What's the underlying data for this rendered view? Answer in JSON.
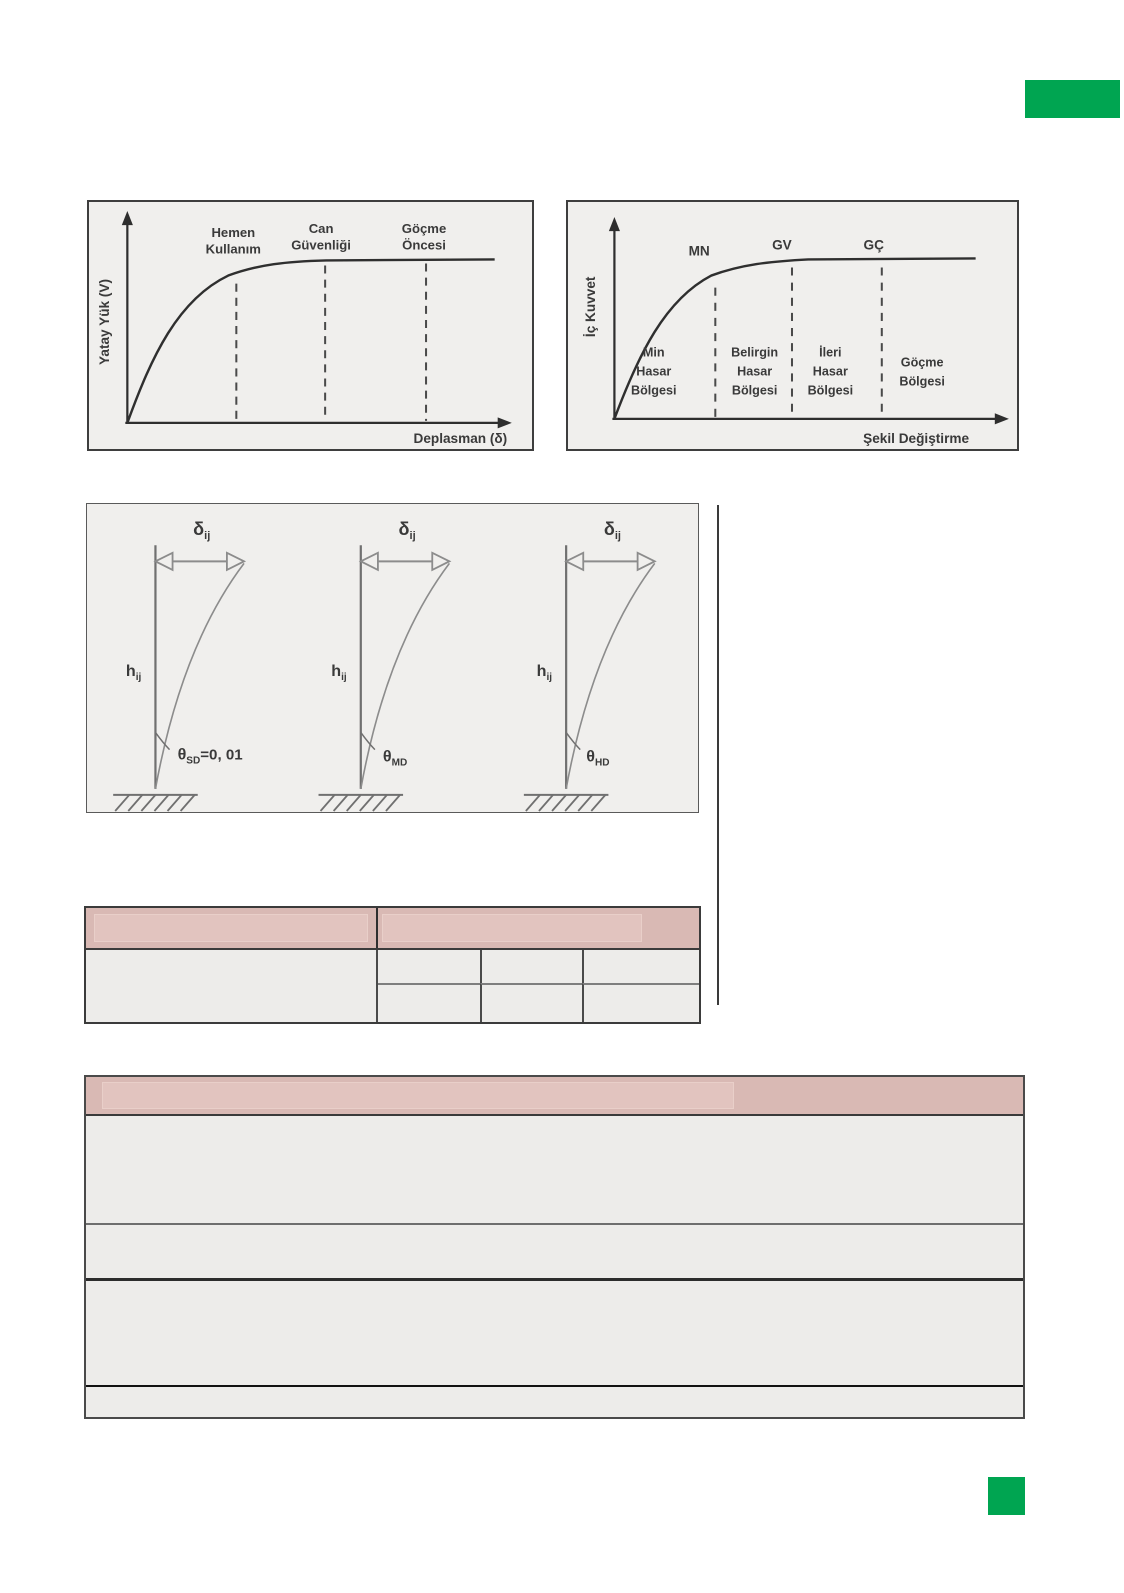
{
  "colors": {
    "accent_green": "#00a551",
    "panel_fill": "#f0efed",
    "table_header_pink": "#d9b9b4",
    "table_cell_gray": "#edecea"
  },
  "chart_data": [
    {
      "type": "line",
      "id": "lateral-load-displacement-performance-levels",
      "title": "",
      "ylabel": "Yatay Yük (V)",
      "xlabel": "Deplasman (δ)",
      "axis_arrows": true,
      "grid": false,
      "series": [
        {
          "name": "capacity-curve",
          "shape": "rise-then-plateau",
          "x_frac": [
            0,
            0.1,
            0.2,
            0.3,
            0.45,
            0.6,
            0.8,
            1.0
          ],
          "y_frac": [
            0,
            0.45,
            0.75,
            0.9,
            0.97,
            1.0,
            1.0,
            1.0
          ]
        }
      ],
      "markers": [
        {
          "lines": [
            "Hemen",
            "Kullanım"
          ],
          "x_frac": 0.3
        },
        {
          "lines": [
            "Can",
            "Güvenliği"
          ],
          "x_frac": 0.54
        },
        {
          "lines": [
            "Göçme",
            "Öncesi"
          ],
          "x_frac": 0.81
        }
      ]
    },
    {
      "type": "line",
      "id": "internal-force-deformation-damage-regions",
      "title": "",
      "ylabel": "İç Kuvvet",
      "xlabel": "Şekil Değiştirme",
      "axis_arrows": true,
      "grid": false,
      "series": [
        {
          "name": "force-deformation-curve",
          "shape": "rise-then-plateau",
          "x_frac": [
            0,
            0.1,
            0.2,
            0.3,
            0.45,
            0.6,
            0.8,
            1.0
          ],
          "y_frac": [
            0,
            0.45,
            0.75,
            0.9,
            0.97,
            1.0,
            1.0,
            1.0
          ]
        }
      ],
      "markers": [
        {
          "label": "MN",
          "x_frac": 0.28
        },
        {
          "label": "GV",
          "x_frac": 0.49
        },
        {
          "label": "GÇ",
          "x_frac": 0.74
        }
      ],
      "regions": [
        {
          "lines": [
            "Min",
            "Hasar",
            "Bölgesi"
          ]
        },
        {
          "lines": [
            "Belirgin",
            "Hasar",
            "Bölgesi"
          ]
        },
        {
          "lines": [
            "İleri",
            "Hasar",
            "Bölgesi"
          ]
        },
        {
          "lines": [
            "Göçme",
            "Bölgesi"
          ]
        }
      ]
    }
  ],
  "column_figure": {
    "delta": "δ",
    "delta_sub": "ij",
    "h": "h",
    "h_sub": "ij",
    "theta": "θ",
    "columns": [
      {
        "sub": "SD",
        "suffix": "=0, 01"
      },
      {
        "sub": "MD",
        "suffix": ""
      },
      {
        "sub": "HD",
        "suffix": ""
      }
    ]
  },
  "middle_table": {
    "header": [
      "",
      ""
    ],
    "left_cell": "",
    "grid": {
      "columns": 3,
      "rows": 2,
      "cells": [
        "",
        "",
        "",
        "",
        "",
        ""
      ]
    }
  },
  "bottom_table": {
    "header": "",
    "rows": [
      "",
      "",
      "",
      ""
    ]
  }
}
